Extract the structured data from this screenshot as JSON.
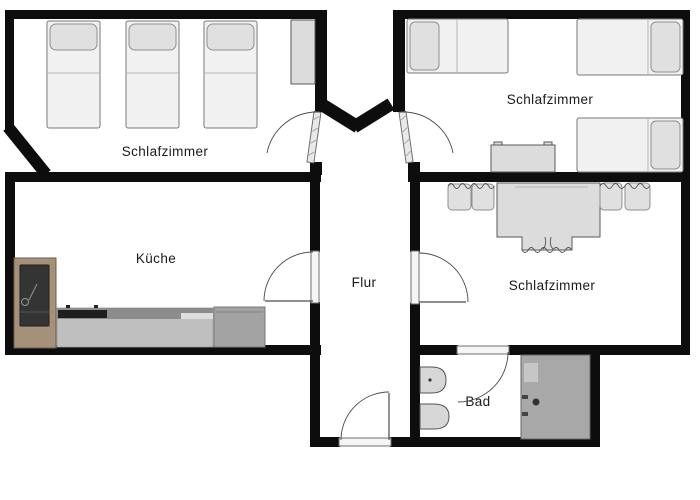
{
  "image": {
    "type": "floor-plan",
    "width": 700,
    "height": 500
  },
  "colors": {
    "wall": "#0d0d0d",
    "background": "#ffffff",
    "bed_fill": "#f1f1f1",
    "pillow_fill": "#e0e0e0",
    "furniture_fill": "#dcdcdc",
    "counter_fill": "#bfbfbf",
    "counter_top": "#8c8c8c",
    "cooktop": "#1e1e1e",
    "appliance_fill": "#a3a3a3",
    "wood_cabinet": "#a5907a",
    "wood_cabinet_panel": "#343434",
    "shower_fill": "#a8a8a8",
    "fixture_fill": "#d7d7d7",
    "label_color": "#1a1a1a"
  },
  "rooms": [
    {
      "id": "bedroom-top-left",
      "label": "Schlafzimmer",
      "furniture": [
        "single bed",
        "single bed",
        "single bed",
        "wall cabinet"
      ]
    },
    {
      "id": "bedroom-top-right",
      "label": "Schlafzimmer",
      "furniture": [
        "single bed",
        "single bed",
        "single bed",
        "side table"
      ]
    },
    {
      "id": "bedroom-right",
      "label": "Schlafzimmer",
      "furniture": [
        "double bed with cushions"
      ]
    },
    {
      "id": "kitchen",
      "label": "Küche",
      "furniture": [
        "tall oven cabinet",
        "counter with cooktop",
        "under-counter appliance"
      ]
    },
    {
      "id": "hallway",
      "label": "Flur",
      "furniture": []
    },
    {
      "id": "bathroom",
      "label": "Bad",
      "furniture": [
        "sink",
        "toilet",
        "shower"
      ]
    }
  ],
  "doors": [
    "door-bedroom-top-left",
    "door-bedroom-top-right",
    "door-kitchen",
    "door-bedroom-right",
    "door-bathroom",
    "entrance-door"
  ]
}
